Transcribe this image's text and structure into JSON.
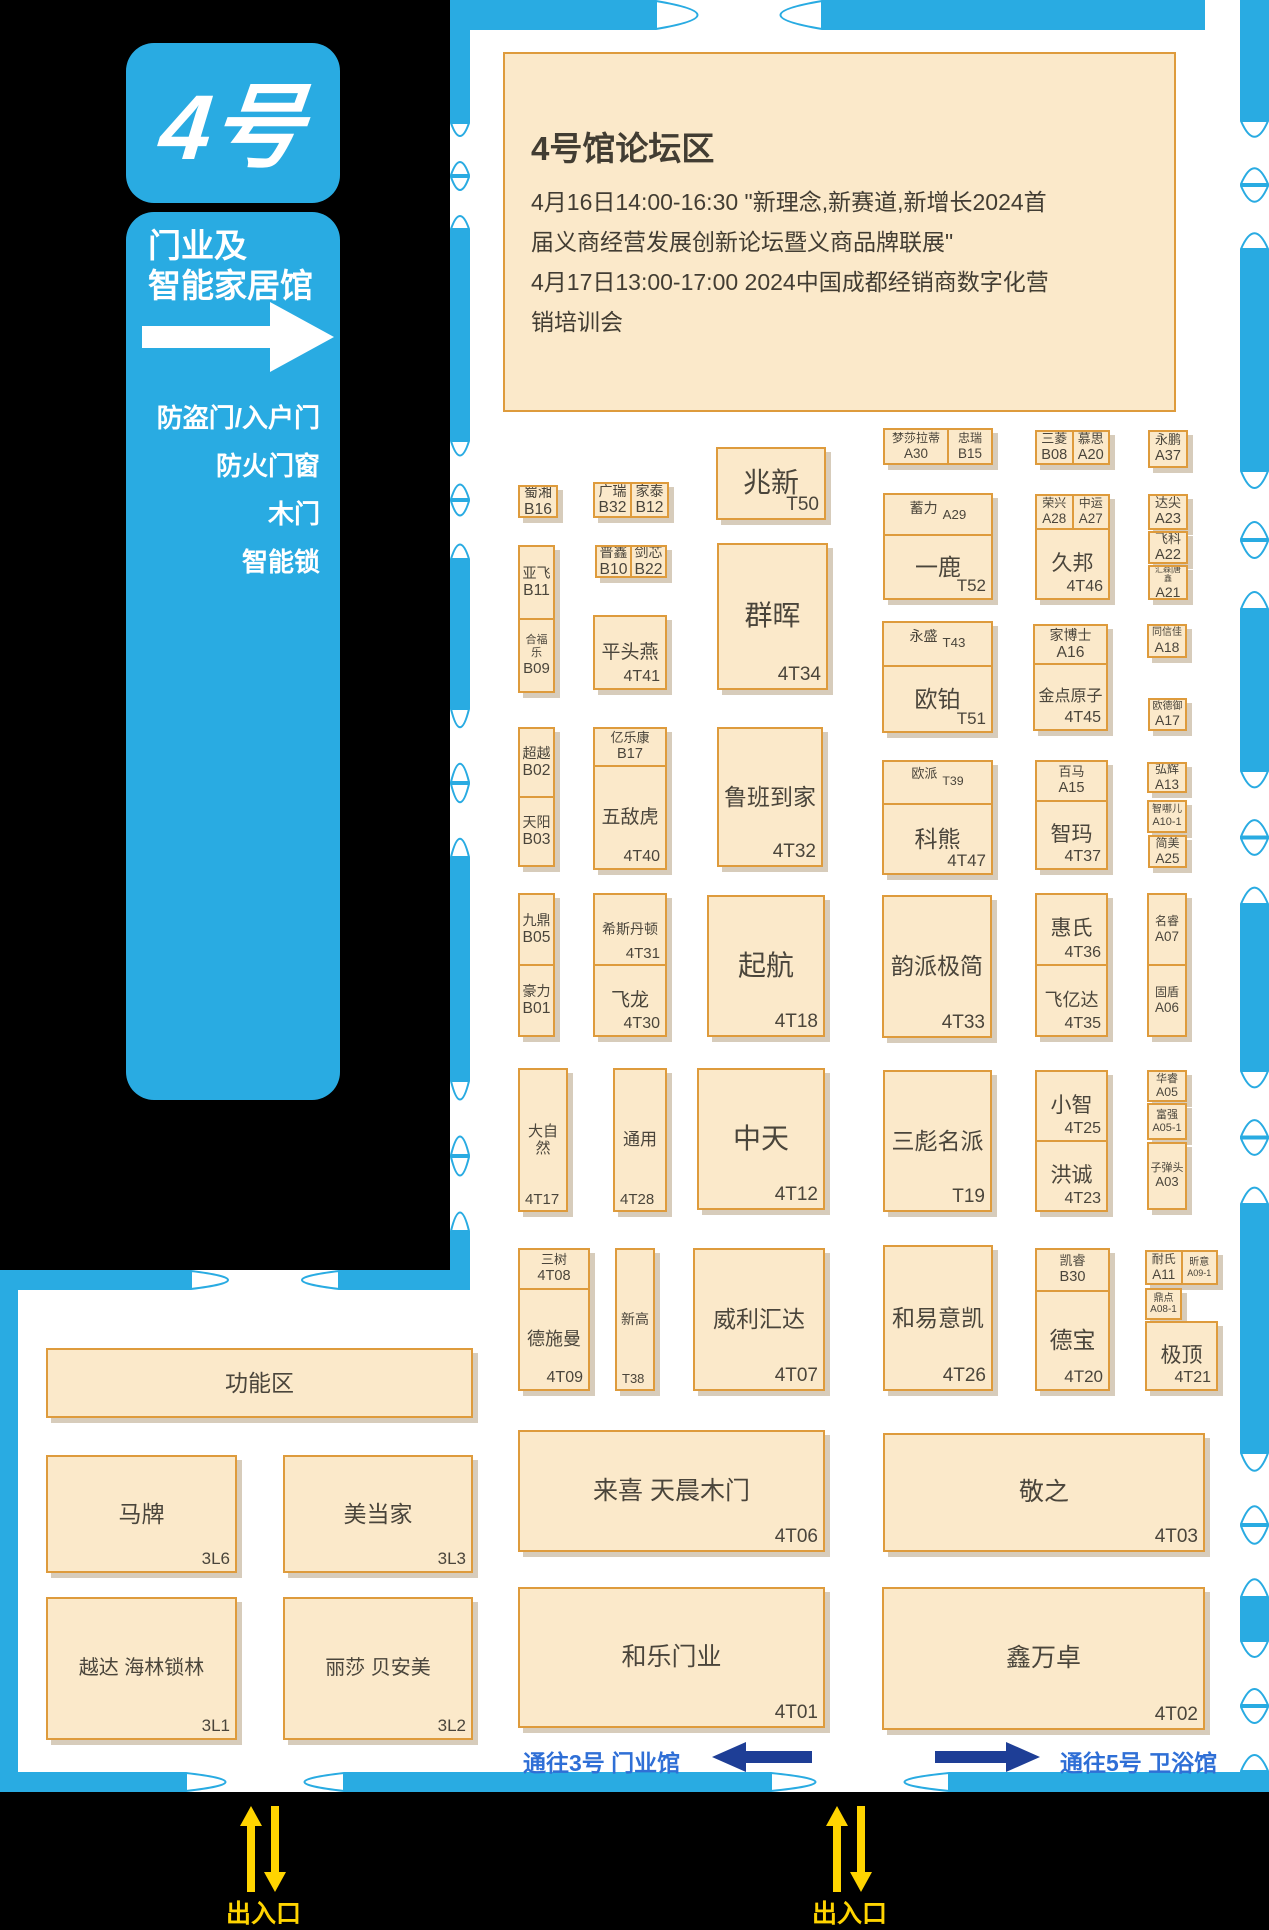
{
  "sidebar": {
    "badge": "4号",
    "hall_line1": "门业及",
    "hall_line2": "智能家居馆",
    "categories": [
      "防盗门/入户门",
      "防火门窗",
      "木门",
      "智能锁"
    ]
  },
  "forum": {
    "title": "4号馆论坛区",
    "line1": "4月16日14:00-16:30   \"新理念,新赛道,新增长2024首",
    "line2": "届义商经营发展创新论坛暨义商品牌联展\"",
    "line3": "4月17日13:00-17:00   2024中国成都经销商数字化营",
    "line4": "销培训会"
  },
  "routes": {
    "left": "通往3号 门业馆",
    "right": "通往5号 卫浴馆"
  },
  "entrances": [
    "出入口",
    "出入口"
  ],
  "colors": {
    "wall_blue": "#29abe2",
    "booth_fill": "#fbe9ca",
    "booth_border": "#de9b3c",
    "booth_text": "#4a453b",
    "navy_arrow": "#1e3e96",
    "route_text": "#2f6fd6",
    "entrance_yellow": "#ffd400"
  },
  "booths": [
    {
      "x": 518,
      "y": 485,
      "w": 40,
      "h": 33,
      "cells": [
        {
          "n": "蜀湘",
          "c": "B16",
          "st": "s",
          "fs": 14
        }
      ]
    },
    {
      "x": 593,
      "y": 482,
      "w": 76,
      "h": 36,
      "dir": "row",
      "cells": [
        {
          "n": "广瑞",
          "c": "B32",
          "st": "s",
          "fs": 14
        },
        {
          "n": "家泰",
          "c": "B12",
          "st": "s",
          "fs": 14
        }
      ]
    },
    {
      "x": 518,
      "y": 545,
      "w": 37,
      "h": 148,
      "cells": [
        {
          "n": "亚飞",
          "c": "B11",
          "st": "s",
          "fs": 14
        },
        {
          "n": "合福乐",
          "c": "B09",
          "st": "s",
          "fs": 11,
          "cfs": 15
        }
      ]
    },
    {
      "x": 595,
      "y": 545,
      "w": 72,
      "h": 33,
      "dir": "row",
      "cells": [
        {
          "n": "普鑫",
          "c": "B10",
          "st": "s",
          "fs": 14
        },
        {
          "n": "剑芯",
          "c": "B22",
          "st": "s",
          "fs": 14
        }
      ]
    },
    {
      "x": 593,
      "y": 615,
      "w": 74,
      "h": 75,
      "cells": [
        {
          "n": "平头燕",
          "c": "4T41",
          "st": "br",
          "fs": 19,
          "cfs": 16
        }
      ]
    },
    {
      "x": 716,
      "y": 447,
      "w": 110,
      "h": 73,
      "cells": [
        {
          "n": "兆新",
          "c": "T50",
          "st": "br",
          "fs": 28,
          "cfs": 19
        }
      ]
    },
    {
      "x": 717,
      "y": 543,
      "w": 111,
      "h": 147,
      "cells": [
        {
          "n": "群晖",
          "c": "4T34",
          "st": "br",
          "fs": 28,
          "cfs": 19
        }
      ]
    },
    {
      "x": 518,
      "y": 727,
      "w": 37,
      "h": 140,
      "cells": [
        {
          "n": "超越",
          "c": "B02",
          "st": "s",
          "fs": 14
        },
        {
          "n": "天阳",
          "c": "B03",
          "st": "s",
          "fs": 14
        }
      ]
    },
    {
      "x": 593,
      "y": 727,
      "w": 74,
      "h": 143,
      "cells": [
        {
          "n": "亿乐康",
          "c": "B17",
          "st": "s",
          "fs": 13,
          "flex": "0 0 34px"
        },
        {
          "n": "五敌虎",
          "c": "4T40",
          "st": "br",
          "fs": 19,
          "cfs": 16
        }
      ]
    },
    {
      "x": 717,
      "y": 727,
      "w": 106,
      "h": 140,
      "cells": [
        {
          "n": "鲁班到家",
          "c": "4T32",
          "st": "br",
          "fs": 23,
          "cfs": 19
        }
      ]
    },
    {
      "x": 518,
      "y": 893,
      "w": 37,
      "h": 144,
      "cells": [
        {
          "n": "九鼎",
          "c": "B05",
          "st": "s",
          "fs": 14
        },
        {
          "n": "豪力",
          "c": "B01",
          "st": "s",
          "fs": 14
        }
      ]
    },
    {
      "x": 593,
      "y": 893,
      "w": 74,
      "h": 144,
      "cells": [
        {
          "n": "希斯丹顿",
          "c": "4T31",
          "st": "br",
          "fs": 14,
          "cfs": 15
        },
        {
          "n": "飞龙",
          "c": "4T30",
          "st": "br",
          "fs": 19,
          "cfs": 16
        }
      ]
    },
    {
      "x": 707,
      "y": 895,
      "w": 118,
      "h": 142,
      "cells": [
        {
          "n": "起航",
          "c": "4T18",
          "st": "br",
          "fs": 28,
          "cfs": 19
        }
      ]
    },
    {
      "x": 518,
      "y": 1068,
      "w": 50,
      "h": 144,
      "cells": [
        {
          "n": "大自然",
          "c": "4T17",
          "st": "bl",
          "fs": 15,
          "cfs": 15
        }
      ]
    },
    {
      "x": 613,
      "y": 1068,
      "w": 54,
      "h": 144,
      "cells": [
        {
          "n": "通用",
          "c": "4T28",
          "st": "bl",
          "fs": 17,
          "cfs": 15
        }
      ]
    },
    {
      "x": 697,
      "y": 1068,
      "w": 128,
      "h": 142,
      "cells": [
        {
          "n": "中天",
          "c": "4T12",
          "st": "br",
          "fs": 28,
          "cfs": 19
        }
      ]
    },
    {
      "x": 518,
      "y": 1248,
      "w": 72,
      "h": 143,
      "cells": [
        {
          "n": "三树",
          "c": "4T08",
          "st": "s",
          "fs": 13,
          "flex": "0 0 36px"
        },
        {
          "n": "德施曼",
          "c": "4T09",
          "st": "br",
          "fs": 18,
          "cfs": 16
        }
      ]
    },
    {
      "x": 615,
      "y": 1248,
      "w": 40,
      "h": 143,
      "cells": [
        {
          "n": "新高",
          "c": "T38",
          "st": "bl",
          "fs": 14,
          "cfs": 13
        }
      ]
    },
    {
      "x": 693,
      "y": 1248,
      "w": 132,
      "h": 143,
      "cells": [
        {
          "n": "威利汇达",
          "c": "4T07",
          "st": "br",
          "fs": 23,
          "cfs": 19
        }
      ]
    },
    {
      "x": 518,
      "y": 1430,
      "w": 307,
      "h": 122,
      "cells": [
        {
          "n": "来喜 天晨木门",
          "c": "4T06",
          "st": "br",
          "fs": 25,
          "cfs": 19
        }
      ]
    },
    {
      "x": 518,
      "y": 1587,
      "w": 307,
      "h": 141,
      "cells": [
        {
          "n": "和乐门业",
          "c": "4T01",
          "st": "br",
          "fs": 25,
          "cfs": 19
        }
      ]
    },
    {
      "x": 883,
      "y": 428,
      "w": 110,
      "h": 37,
      "dir": "row",
      "cells": [
        {
          "n": "梦莎拉蒂",
          "c": "A30",
          "st": "s",
          "fs": 12,
          "flex": "1.5 1 0"
        },
        {
          "n": "忠瑞",
          "c": "B15",
          "st": "s",
          "fs": 12
        }
      ]
    },
    {
      "x": 883,
      "y": 493,
      "w": 110,
      "h": 107,
      "cells": [
        {
          "n": "蓄力",
          "c": "A29",
          "st": "in",
          "fs": 14,
          "flex": "0 0 33px"
        },
        {
          "n": "一鹿",
          "c": "T52",
          "st": "br",
          "fs": 23,
          "cfs": 17
        }
      ]
    },
    {
      "x": 882,
      "y": 621,
      "w": 111,
      "h": 112,
      "cells": [
        {
          "n": "永盛",
          "c": "T43",
          "st": "in",
          "fs": 14,
          "flex": "0 0 36px"
        },
        {
          "n": "欧铂",
          "c": "T51",
          "st": "br",
          "fs": 23,
          "cfs": 17
        }
      ]
    },
    {
      "x": 882,
      "y": 760,
      "w": 111,
      "h": 115,
      "cells": [
        {
          "n": "欧派",
          "c": "T39",
          "st": "in",
          "fs": 13,
          "flex": "0 0 35px"
        },
        {
          "n": "科熊",
          "c": "4T47",
          "st": "br",
          "fs": 23,
          "cfs": 17
        }
      ]
    },
    {
      "x": 882,
      "y": 895,
      "w": 110,
      "h": 143,
      "cells": [
        {
          "n": "韵派极简",
          "c": "4T33",
          "st": "br",
          "fs": 23,
          "cfs": 19
        }
      ]
    },
    {
      "x": 883,
      "y": 1070,
      "w": 109,
      "h": 142,
      "cells": [
        {
          "n": "三彪名派",
          "c": "T19",
          "st": "br",
          "fs": 23,
          "cfs": 19
        }
      ]
    },
    {
      "x": 883,
      "y": 1245,
      "w": 110,
      "h": 146,
      "cells": [
        {
          "n": "和易意凯",
          "c": "4T26",
          "st": "br",
          "fs": 23,
          "cfs": 19
        }
      ]
    },
    {
      "x": 883,
      "y": 1433,
      "w": 322,
      "h": 119,
      "cells": [
        {
          "n": "敬之",
          "c": "4T03",
          "st": "br",
          "fs": 25,
          "cfs": 19
        }
      ]
    },
    {
      "x": 882,
      "y": 1587,
      "w": 323,
      "h": 143,
      "cells": [
        {
          "n": "鑫万卓",
          "c": "4T02",
          "st": "br",
          "fs": 25,
          "cfs": 19
        }
      ]
    },
    {
      "x": 1035,
      "y": 430,
      "w": 75,
      "h": 35,
      "dir": "row",
      "cells": [
        {
          "n": "三菱",
          "c": "B08",
          "st": "s",
          "fs": 13
        },
        {
          "n": "慕思",
          "c": "A20",
          "st": "s",
          "fs": 13
        }
      ]
    },
    {
      "x": 1035,
      "y": 494,
      "w": 75,
      "h": 106,
      "cells": [
        {
          "dir": "row",
          "flex": "0 0 32px",
          "cells": [
            {
              "n": "荣兴",
              "c": "A28",
              "st": "s",
              "fs": 12
            },
            {
              "n": "中运",
              "c": "A27",
              "st": "s",
              "fs": 12
            }
          ]
        },
        {
          "n": "久邦",
          "c": "4T46",
          "st": "br",
          "fs": 21,
          "cfs": 16
        }
      ]
    },
    {
      "x": 1033,
      "y": 624,
      "w": 75,
      "h": 107,
      "cells": [
        {
          "n": "家博士",
          "c": "A16",
          "st": "s",
          "fs": 14,
          "flex": "0 0 35px"
        },
        {
          "n": "金点原子",
          "c": "4T45",
          "st": "br",
          "fs": 16,
          "cfs": 16
        }
      ]
    },
    {
      "x": 1035,
      "y": 760,
      "w": 73,
      "h": 110,
      "cells": [
        {
          "n": "百马",
          "c": "A15",
          "st": "s",
          "fs": 13,
          "flex": "0 0 36px"
        },
        {
          "n": "智玛",
          "c": "4T37",
          "st": "br",
          "fs": 21,
          "cfs": 16
        }
      ]
    },
    {
      "x": 1035,
      "y": 893,
      "w": 73,
      "h": 144,
      "cells": [
        {
          "n": "惠氏",
          "c": "4T36",
          "st": "br",
          "fs": 21,
          "cfs": 16
        },
        {
          "n": "飞亿达",
          "c": "4T35",
          "st": "br",
          "fs": 18,
          "cfs": 16
        }
      ]
    },
    {
      "x": 1035,
      "y": 1070,
      "w": 73,
      "h": 142,
      "cells": [
        {
          "n": "小智",
          "c": "4T25",
          "st": "br",
          "fs": 21,
          "cfs": 16
        },
        {
          "n": "洪诚",
          "c": "4T23",
          "st": "br",
          "fs": 21,
          "cfs": 16
        }
      ]
    },
    {
      "x": 1035,
      "y": 1248,
      "w": 75,
      "h": 143,
      "cells": [
        {
          "n": "凯睿",
          "c": "B30",
          "st": "s",
          "fs": 13,
          "flex": "0 0 38px"
        },
        {
          "n": "德宝",
          "c": "4T20",
          "st": "br",
          "fs": 23,
          "cfs": 17
        }
      ]
    },
    {
      "x": 1148,
      "y": 430,
      "w": 40,
      "h": 38,
      "cells": [
        {
          "n": "永鹏",
          "c": "A37",
          "st": "s",
          "fs": 13
        }
      ]
    },
    {
      "x": 1148,
      "y": 494,
      "w": 40,
      "h": 36,
      "cells": [
        {
          "n": "达尖",
          "c": "A23",
          "st": "s",
          "fs": 13
        }
      ]
    },
    {
      "x": 1148,
      "y": 531,
      "w": 40,
      "h": 33,
      "cells": [
        {
          "n": "飞科",
          "c": "A22",
          "st": "s",
          "fs": 13
        }
      ]
    },
    {
      "x": 1148,
      "y": 565,
      "w": 40,
      "h": 35,
      "cells": [
        {
          "n": "汇森|唐鑫",
          "c": "A21",
          "st": "s",
          "fs": 8,
          "cfs": 14
        }
      ]
    },
    {
      "x": 1147,
      "y": 624,
      "w": 40,
      "h": 34,
      "cells": [
        {
          "n": "同信佳",
          "c": "A18",
          "st": "s",
          "fs": 10,
          "cfs": 14
        }
      ]
    },
    {
      "x": 1148,
      "y": 698,
      "w": 39,
      "h": 33,
      "cells": [
        {
          "n": "欧德御",
          "c": "A17",
          "st": "s",
          "fs": 10,
          "cfs": 14
        }
      ]
    },
    {
      "x": 1147,
      "y": 762,
      "w": 40,
      "h": 31,
      "cells": [
        {
          "n": "弘辉",
          "c": "A13",
          "st": "s",
          "fs": 12
        }
      ]
    },
    {
      "x": 1147,
      "y": 800,
      "w": 40,
      "h": 33,
      "cells": [
        {
          "n": "智哪儿",
          "c": "A10-1",
          "st": "s",
          "fs": 10,
          "cfs": 11
        }
      ]
    },
    {
      "x": 1148,
      "y": 835,
      "w": 39,
      "h": 33,
      "cells": [
        {
          "n": "简美",
          "c": "A25",
          "st": "s",
          "fs": 12
        }
      ]
    },
    {
      "x": 1147,
      "y": 893,
      "w": 40,
      "h": 144,
      "cells": [
        {
          "n": "名睿",
          "c": "A07",
          "st": "s",
          "fs": 12
        },
        {
          "n": "固盾",
          "c": "A06",
          "st": "s",
          "fs": 12
        }
      ]
    },
    {
      "x": 1147,
      "y": 1070,
      "w": 40,
      "h": 32,
      "cells": [
        {
          "n": "华睿",
          "c": "A05",
          "st": "s",
          "fs": 11
        }
      ]
    },
    {
      "x": 1147,
      "y": 1103,
      "w": 40,
      "h": 37,
      "cells": [
        {
          "n": "富强",
          "c": "A05-1",
          "st": "s",
          "fs": 11,
          "cfs": 11
        }
      ]
    },
    {
      "x": 1147,
      "y": 1142,
      "w": 40,
      "h": 68,
      "cells": [
        {
          "n": "子弹头",
          "c": "A03",
          "st": "s",
          "fs": 11,
          "cfs": 13
        }
      ]
    },
    {
      "x": 1145,
      "y": 1250,
      "w": 73,
      "h": 35,
      "dir": "row",
      "cells": [
        {
          "n": "耐氏",
          "c": "A11",
          "st": "s",
          "fs": 12
        },
        {
          "n": "昕意",
          "c": "A09-1",
          "st": "s",
          "fs": 10,
          "cfs": 9
        }
      ]
    },
    {
      "x": 1145,
      "y": 1288,
      "w": 37,
      "h": 32,
      "cells": [
        {
          "n": "鼎点",
          "c": "A08-1",
          "st": "s",
          "fs": 10,
          "cfs": 10
        }
      ]
    },
    {
      "x": 1145,
      "y": 1321,
      "w": 73,
      "h": 70,
      "cells": [
        {
          "n": "极顶",
          "c": "4T21",
          "st": "br",
          "fs": 21,
          "cfs": 16
        }
      ]
    },
    {
      "x": 46,
      "y": 1348,
      "w": 427,
      "h": 70,
      "cells": [
        {
          "n": "功能区",
          "st": "c",
          "fs": 23
        }
      ]
    },
    {
      "x": 46,
      "y": 1455,
      "w": 191,
      "h": 118,
      "cells": [
        {
          "n": "马牌",
          "c": "3L6",
          "st": "br",
          "fs": 23,
          "cfs": 17
        }
      ]
    },
    {
      "x": 283,
      "y": 1455,
      "w": 190,
      "h": 118,
      "cells": [
        {
          "n": "美当家",
          "c": "3L3",
          "st": "br",
          "fs": 23,
          "cfs": 17
        }
      ]
    },
    {
      "x": 46,
      "y": 1597,
      "w": 191,
      "h": 143,
      "cells": [
        {
          "n": "越达 海林锁林",
          "c": "3L1",
          "st": "br",
          "fs": 20,
          "cfs": 17
        }
      ]
    },
    {
      "x": 283,
      "y": 1597,
      "w": 190,
      "h": 143,
      "cells": [
        {
          "n": "丽莎 贝安美",
          "c": "3L2",
          "st": "br",
          "fs": 20,
          "cfs": 17
        }
      ]
    }
  ]
}
